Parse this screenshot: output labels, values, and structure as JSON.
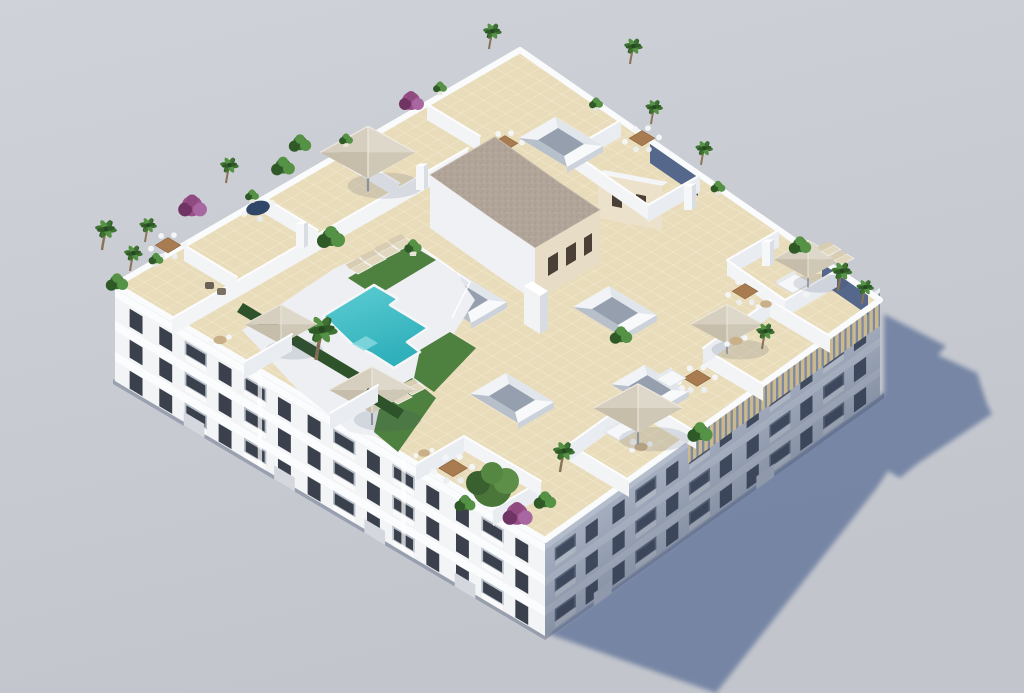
{
  "meta": {
    "description": "Aerial isometric 3D architectural rendering of a white apartment block with a landscaped communal rooftop terrace, swimming pool and private terraces, on a plain grey studio background with a long cast shadow to the lower right",
    "view": "isometric aerial 3D render",
    "visible_text": ""
  },
  "palette": {
    "background_top": "#cfd2d9",
    "background_bottom": "#c2c5cc",
    "shadow": "#6e7fa0",
    "shadow_notch": "#56678c",
    "facade_lit": "#f3f4f6",
    "facade_band": "#fbfcfd",
    "facade_recess": "#b7bfc9",
    "window_dark": "#3a414d",
    "facade_shade": "#a7b1c2",
    "recess_shade": "#5f6a7f",
    "window_shade": "#414b5e",
    "roof_tile": "#e9dcba",
    "tile_line": "#f5edd5",
    "parapet": "#fafbfc",
    "deck": "#edeff2",
    "pool_light": "#5ecdd3",
    "pool_deep": "#2fb0bb",
    "lawn": "#4e8040",
    "hedge": "#2e5229",
    "umbrella_light": "#ded8ca",
    "umbrella_dark": "#c6beaa",
    "wood": "#a87c50",
    "gravel_roof": "#b1a499",
    "cream_wall": "#e7dcc6",
    "pergola_wood": "#cbb98e",
    "plant_green": "#3e7233",
    "plant_light": "#559245",
    "plant_dark": "#2f5a28",
    "bougainvillea": "#9a4f8a"
  },
  "building": {
    "floors_visible": 3,
    "left_facade": {
      "cols": 14,
      "pattern": "wwbwbwwbwbwwbw",
      "rows": [
        14,
        45,
        76
      ],
      "u0": 12,
      "du": 34.5,
      "h": 20
    },
    "right_facade": {
      "cols": 12,
      "pattern": "bwwbwbwwbwbw",
      "rows": [
        15,
        46,
        76
      ],
      "u0": 12,
      "du": 33,
      "h": 19
    },
    "pergola_on_right_roofline": true
  },
  "rooftop": {
    "amenities": [
      "swimming pool",
      "lawn areas",
      "sun loungers",
      "parasols",
      "private dining terraces",
      "roof light-wells",
      "stair core with gravel roof",
      "planters with palms",
      "bougainvillea shrubs",
      "timber pergola"
    ],
    "counts": {
      "skylights": 5,
      "parasols": 6,
      "palm_trees": 15,
      "dining_sets": 7,
      "sofas": 3,
      "sun_loungers": 6,
      "bougainvillea": 3
    }
  }
}
